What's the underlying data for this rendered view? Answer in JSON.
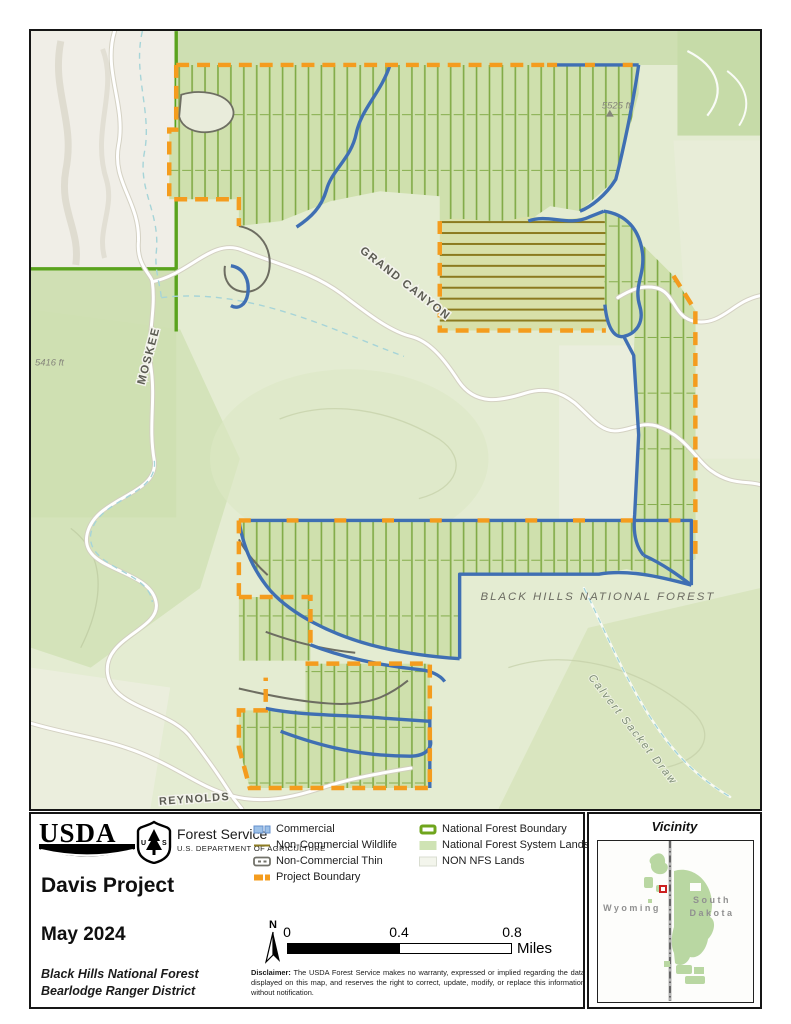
{
  "map_labels": {
    "road_grand_canyon": "GRAND CANYON",
    "road_moskee": "MOSKEE",
    "road_reynolds": "REYNOLDS",
    "forest_name": "BLACK HILLS NATIONAL FOREST",
    "stream_name": "Calvert Sacket Draw",
    "elev_1": "5525 ft",
    "elev_2": "5416 ft"
  },
  "title_block": {
    "usda": "USDA",
    "agency": "Forest Service",
    "department": "U.S. DEPARTMENT OF AGRICULTURE",
    "title": "Davis Project",
    "date": "May 2024",
    "unit_line1": "Black Hills National Forest",
    "unit_line2": "Bearlodge Ranger District"
  },
  "legend": {
    "left": [
      "Commercial",
      "Non-Commercial Wildlife",
      "Non-Commercial Thin",
      "Project Boundary"
    ],
    "right": [
      "National Forest Boundary",
      "National Forest System Lands",
      "NON NFS Lands"
    ]
  },
  "scale": {
    "north": "N",
    "t0": "0",
    "t1": "0.4",
    "t2": "0.8",
    "unit": "Miles"
  },
  "disclaimer": {
    "label": "Disclaimer:",
    "text": " The USDA Forest Service makes no warranty, expressed or implied regarding the data displayed on this map, and reserves the right to correct, update, modify, or replace this information without notification."
  },
  "vicinity": {
    "title": "Vicinity",
    "state_left": "Wyoming",
    "state_right_1": "South",
    "state_right_2": "Dakota"
  },
  "colors": {
    "project_boundary": "#F49C1E",
    "commercial": "#3F6FB3",
    "wildlife": "#8C7B22",
    "nf_boundary": "#5AA31D",
    "nfs_lands": "#CFE3B4",
    "non_nfs": "#F0EEE7",
    "vicinity_marker": "#CC2020"
  }
}
